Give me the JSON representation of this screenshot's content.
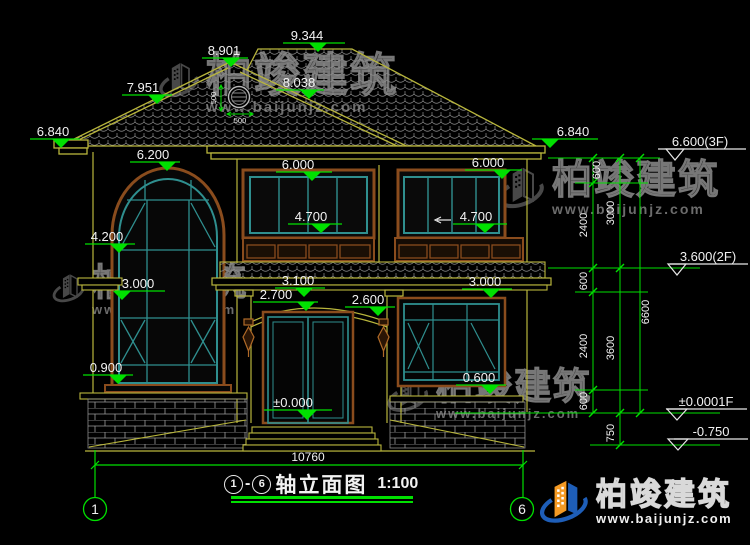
{
  "drawing": {
    "title": {
      "axis_start": "1",
      "separator": "-",
      "axis_end": "6",
      "name": "轴立面图",
      "scale": "1:100"
    },
    "axis_bubbles": {
      "left": "1",
      "right": "6"
    },
    "overall_width": "10760",
    "elevation_flags": [
      "9.344",
      "8.901",
      "7.951",
      "8.038",
      "6.840",
      "6.840",
      "6.200",
      "6.000",
      "6.000",
      "4.700",
      "4.700",
      "4.200",
      "3.000",
      "3.100",
      "2.700",
      "2.600",
      "3.000",
      "±0.000",
      "0.900",
      "0.600"
    ],
    "level_flags": [
      "6.600(3F)",
      "3.600(2F)",
      "±0.0001F",
      "-0.750"
    ],
    "chain_dims": [
      "600",
      "2400",
      "3000",
      "600",
      "2400",
      "3600",
      "6600",
      "600",
      "750"
    ],
    "vent_dims": {
      "width": "500",
      "height": "500"
    }
  },
  "watermark": {
    "brand": "柏竣建筑",
    "url": "www.baijunjz.com"
  },
  "footer_logo": {
    "brand": "柏竣建筑",
    "url": "www.baijunjz.com"
  },
  "colors": {
    "line_yellow": "#b9b63c",
    "dim_green": "#00e000",
    "text_white": "#f2f2f2",
    "frame_brown": "#8a4c1d",
    "window_teal": "#2f8f8f",
    "watermark_gray": "#555555",
    "logo_blue": "#1e5eb8",
    "logo_orange": "#f59a23"
  }
}
